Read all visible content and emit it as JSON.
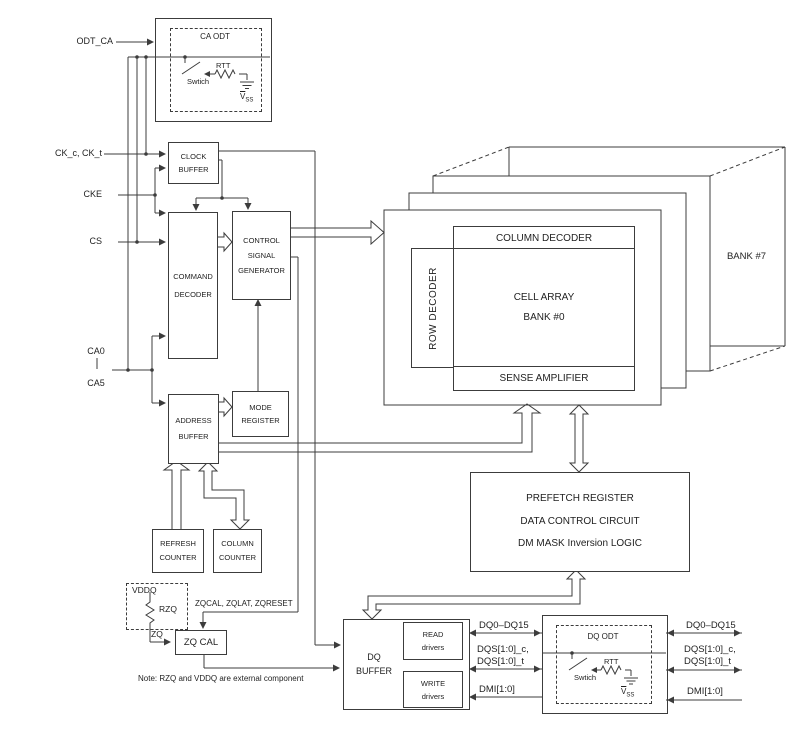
{
  "left_inputs": {
    "odt_ca": "ODT_CA",
    "ck": "CK_c, CK_t",
    "cke": "CKE",
    "cs": "CS",
    "ca0": "CA0",
    "ca5": "CA5"
  },
  "ca_odt": {
    "title": "CA ODT",
    "rtt": "RTT",
    "switch": "Swtich",
    "gnd_base": "V",
    "gnd_sub": "SS"
  },
  "dq_odt": {
    "title": "DQ ODT",
    "rtt": "RTT",
    "switch": "Swtich",
    "gnd_base": "V",
    "gnd_sub": "SS"
  },
  "blocks": {
    "clock_buffer": {
      "line1": "CLOCK",
      "line2": "BUFFER"
    },
    "command_decoder": {
      "line1": "COMMAND",
      "line2": "DECODER"
    },
    "control_signal_generator": {
      "line1": "CONTROL",
      "line2": "SIGNAL",
      "line3": "GENERATOR"
    },
    "address_buffer": {
      "line1": "ADDRESS",
      "line2": "BUFFER"
    },
    "mode_register": {
      "line1": "MODE",
      "line2": "REGISTER"
    },
    "refresh_counter": {
      "line1": "REFRESH",
      "line2": "COUNTER"
    },
    "column_counter": {
      "line1": "COLUMN",
      "line2": "COUNTER"
    },
    "zq_cal": {
      "line1": "ZQ CAL"
    },
    "dq_buffer": {
      "line1": "DQ",
      "line2": "BUFFER"
    },
    "read_drivers": {
      "line1": "READ",
      "line2": "drivers"
    },
    "write_drivers": {
      "line1": "WRITE",
      "line2": "drivers"
    },
    "prefetch": {
      "line1": "PREFETCH REGISTER",
      "line2": "DATA CONTROL CIRCUIT",
      "line3": "DM MASK Inversion LOGIC"
    }
  },
  "bank": {
    "column_decoder": "COLUMN DECODER",
    "row_decoder": "ROW DECODER",
    "cell_array_line1": "CELL ARRAY",
    "cell_array_line2": "BANK #0",
    "sense_amplifier": "SENSE AMPLIFIER",
    "bank7": "BANK #7"
  },
  "io": {
    "dq": "DQ0–DQ15",
    "dqs_c": "DQS[1:0]_c,",
    "dqs_t": "DQS[1:0]_t",
    "dmi": "DMI[1:0]"
  },
  "zq": {
    "vddq": "VDDQ",
    "rzq": "RZQ",
    "zq": "ZQ",
    "commands": "ZQCAL, ZQLAT, ZQRESET"
  },
  "note": "Note: RZQ and VDDQ are external component"
}
